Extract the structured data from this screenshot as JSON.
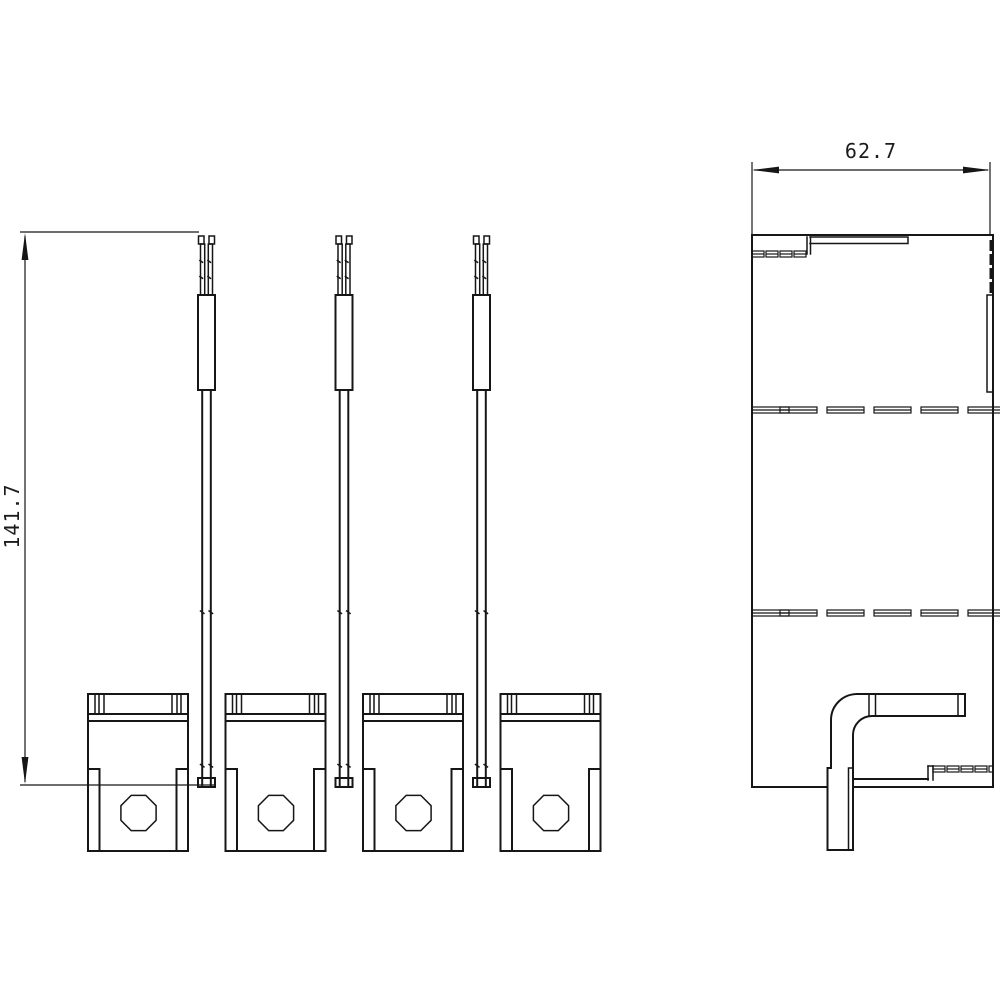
{
  "drawing": {
    "type": "technical-dimension-drawing",
    "background_color": "#ffffff",
    "line_color": "#161616",
    "views": {
      "front": {
        "title": "front-view",
        "rod_count": 3,
        "clamp_count": 4,
        "dimension": {
          "label": "141.7",
          "orientation": "vertical"
        }
      },
      "side": {
        "title": "side-view",
        "dimension": {
          "label": "62.7",
          "orientation": "horizontal"
        }
      }
    }
  }
}
